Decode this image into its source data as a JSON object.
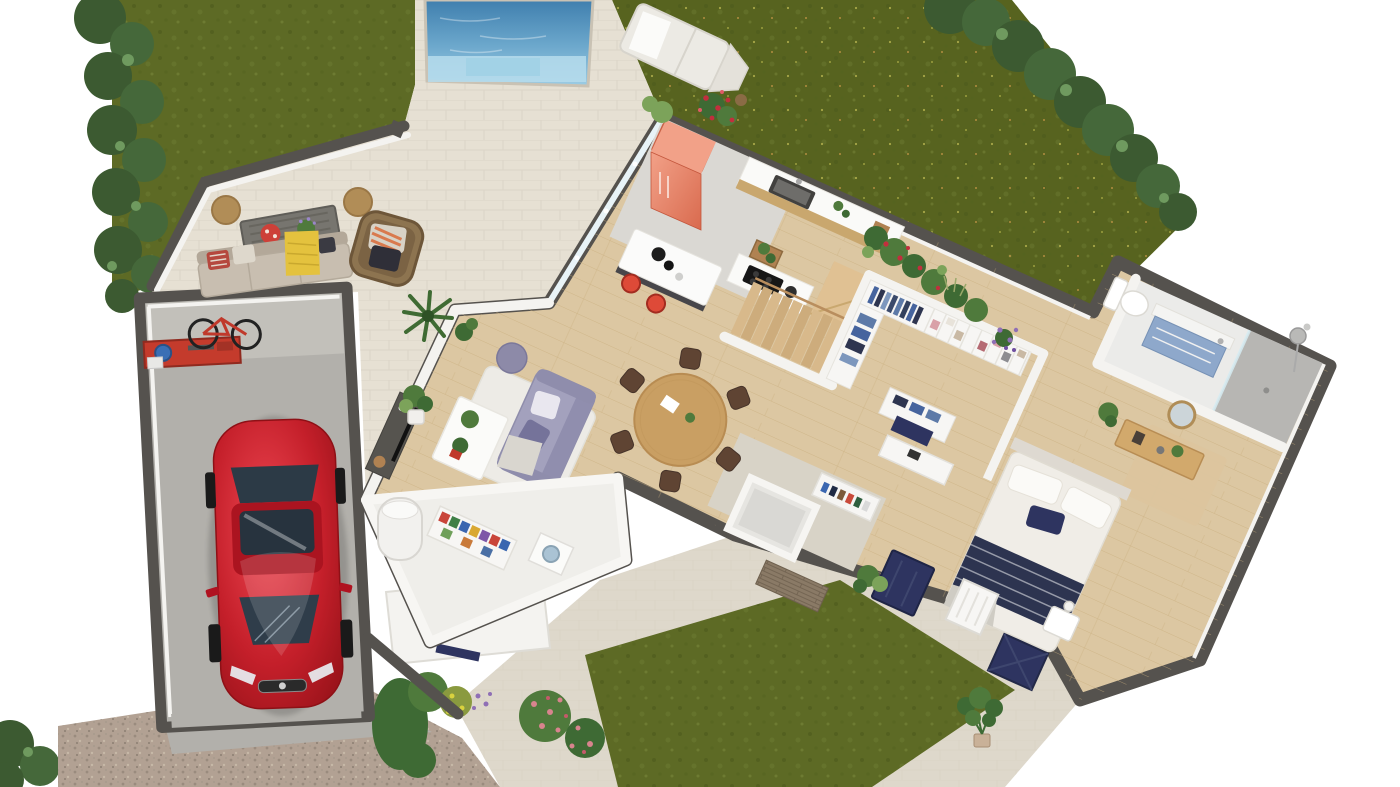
{
  "scene": {
    "title": "3D rendered ground-floor plan: house with pool, garden, terrace and garage",
    "type": "architectural 3D floor plan render",
    "view": "top-down isometric cutaway, house rotated diagonally"
  },
  "palette": {
    "bg": "#ffffff",
    "grass": "#5d6a25",
    "grass2": "#57631f",
    "hedge": "#3c5a31",
    "hedge2": "#45683a",
    "hedgeLight": "#6f9a5f",
    "poolDeep": "#4a88b4",
    "poolShallow": "#9ccce4",
    "poolStep": "#b6dcec",
    "deck": "#e6e0d3",
    "tileFront": "#ded8cb",
    "gravel": "#b2a193",
    "wall": "#55524e",
    "whiteWall": "#f4f3f0",
    "woodFloor": "#dcc7a2",
    "woodFurn": "#d2a96c",
    "woodStairs": "#d8b98b",
    "tileKitchen": "#dad8d3",
    "tileEntry": "#d8d3c7",
    "bathTile": "#ebebe9",
    "showerTile": "#b7b6b3",
    "navy": "#2e3460",
    "red": "#de4a38",
    "coral": "#e88266",
    "coralLight": "#f2a188",
    "sofa": "#a3a1bd",
    "sofaDark": "#908eae",
    "carRed": "#c41f2a",
    "carDark": "#8e1016",
    "carGlass": "#2f3d4a",
    "outdoorBeige": "#c8beb0",
    "throwYellow": "#e4c23e",
    "rattan": "#8d7450",
    "poufTan": "#b18d57",
    "vanityBlue": "#8ea8cb",
    "plant": "#4f7a3c",
    "plantDark": "#3e6a34",
    "plantLight": "#7ca35a",
    "concrete": "#b2b0ab",
    "concreteLight": "#c2c0ba",
    "stoneWall": "#8a7a66"
  },
  "outdoor": {
    "pool": {
      "shape": "rectangular with entry step",
      "water": "blue gradient, shallow step at lower edge"
    },
    "pool_deck": "large light stone paver apron connecting pool to house and lounge terrace",
    "sun_lounger": "white double chaise with towel on lawn right of pool",
    "lawns": [
      "upper-left lawn",
      "large upper-right meadow with wildflower speckles",
      "front yard grass patch"
    ],
    "hedges": [
      "dense hedge along upper-left boundary",
      "hedge row along upper-right boundary",
      "bush at lower-left corner"
    ],
    "flower_beds": [
      "red rose bush near kitchen corner",
      "mixed bed with red and purple flowers along rear wall",
      "front bed with shrubs, pink roses and lavender"
    ],
    "driveway": "gravel drive at lower left leading to open garage",
    "front_path": "stone tile courtyard with monstera plant, navy front door, navy window shutters and white gate",
    "terrace_furniture": [
      "two woven tan poufs",
      "gray slatted coffee table with red plate and lavender plant",
      "beige outdoor sofa with yellow throw and red pillow",
      "rattan armchair with striped pillows",
      "potted palms"
    ]
  },
  "rooms": [
    {
      "name": "garage",
      "floor": "gray concrete",
      "items": [
        "red sports coupe",
        "wall-mounted bicycle",
        "red workbench with tools and blue bucket",
        "white garage door panel"
      ]
    },
    {
      "name": "utility room",
      "floor": "white",
      "items": [
        "white water heater cylinder",
        "shelving with red, green, blue and yellow storage boxes",
        "washing machine"
      ]
    },
    {
      "name": "living room",
      "floor": "light oak",
      "items": [
        "lavender three-seat sofa",
        "white shag rug",
        "white coffee table with two plants",
        "purple pouf",
        "dark TV console",
        "potted palm"
      ]
    },
    {
      "name": "dining area",
      "floor": "light oak",
      "items": [
        "round oak table",
        "six dark wood chairs",
        "white paper and small plant on table"
      ]
    },
    {
      "name": "kitchen",
      "floor": "pale concrete tile",
      "items": [
        "coral retro fridge",
        "counter with dark sink",
        "induction hob counter",
        "white island with charcoal base",
        "two red bar stools",
        "herb pots"
      ]
    },
    {
      "name": "staircase",
      "floor": "oak treads",
      "items": [
        "nine wood treads",
        "corner landing",
        "white guard wall"
      ]
    },
    {
      "name": "walk-in closet",
      "floor": "light oak",
      "items": [
        "white wardrobe with hanging blue clothing",
        "cubby shelves with folded items",
        "drawer unit with denim stacks",
        "navy bench"
      ]
    },
    {
      "name": "entry hall",
      "floor": "stone tile",
      "items": [
        "shoe cabinet",
        "white console",
        "stacked-stone accent wall",
        "fern plant",
        "small WC enclosure"
      ]
    },
    {
      "name": "bedroom",
      "floor": "light oak",
      "items": [
        "double bed with white duvet and navy striped blanket",
        "white bedside table with lamp",
        "oak sideboard",
        "round mirror",
        "tan rug",
        "potted plant"
      ]
    },
    {
      "name": "bathroom",
      "floor": "white tile",
      "items": [
        "toilet",
        "blue vanity with white counter",
        "walk-in shower with gray tile and glass screen",
        "exterior light fixture"
      ]
    }
  ],
  "vehicle": {
    "type": "coupe",
    "color": "red",
    "position": "parked in garage facing driveway"
  }
}
